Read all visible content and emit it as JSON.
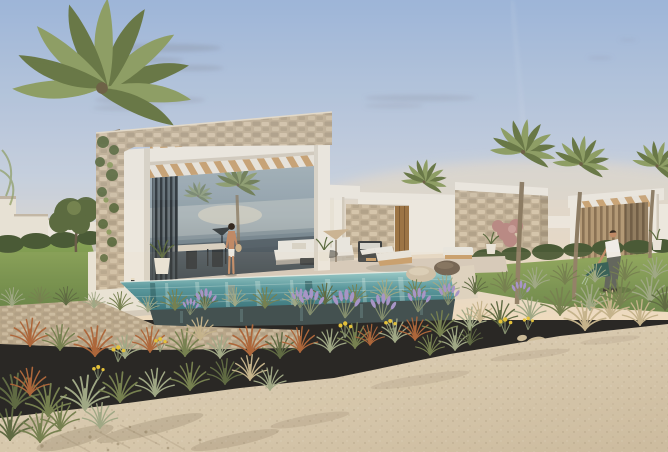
{
  "scene": {
    "type": "architectural-rendering",
    "description": "Architectural rendering of modern single-storey stone-and-white villas with wooden pergolas, an infinity-edge swimming pool, palm trees, ornamental grasses, lavender and a sandy path in the foreground at dusk",
    "time_of_day": "dusk",
    "weather": "clear with thin wispy clouds",
    "buildings": [
      {
        "name": "main-villa",
        "features": "stone parapet, white frame, timber pergola slats, vertical louvers, full-height glazing reflecting sea and palms"
      },
      {
        "name": "middle-villa-wing",
        "features": "white parapet, stone panel, timber door"
      },
      {
        "name": "stone-block-villa",
        "features": "stone clad walls with white parapet"
      },
      {
        "name": "pergola-villa",
        "features": "white pergola frame with tan louvered wall"
      }
    ],
    "people": [
      {
        "name": "woman-by-pool",
        "description": "woman in white shorts standing at the pool terrace edge with a straw bag"
      },
      {
        "name": "man-gardening",
        "description": "man in a white t-shirt watering plants on the lawn with a teal watering can"
      }
    ],
    "palm_tree_count": 5,
    "water_feature": "infinity edge swimming pool over a dry-stacked stone retaining wall",
    "vegetation": "ornamental grasses (olive, sage, rust, straw), lavender clumps, yellow wildflowers, trimmed hedges, lawn, pink flowering shrub",
    "foreground": "light sandy path with scattered pebbles, rocks and plant shadows",
    "furniture": "outdoor dining set, white lounge sofas, timber sun loungers, pebble-shaped poufs, planted pots, parasols"
  },
  "palette": {
    "skyTop": "#9db5d7",
    "skyMid": "#c7d0dd",
    "horizonGlow": "#efdcc0",
    "cloud": "#7e828d",
    "white": "#ece7dd",
    "whiteShade": "#d3cbbc",
    "stoneBase": "#c2b197",
    "stoneDark": "#a6957d",
    "stoneLight": "#d9cab0",
    "wallStone": "#b5a488",
    "wood": "#c79e6b",
    "woodDark": "#a07747",
    "slatBright": "#e9e4da",
    "louverDark": "#272d31",
    "louverTanBase": "#b49a76",
    "louverTanDark": "#8a7254",
    "glassTop": "#a8b4ba",
    "glassMid": "#90a0a8",
    "glassDark": "#49545b",
    "seaRef": "#7b8a92",
    "trunk": "#8d7c63",
    "trunkLight": "#a5947a",
    "palmDark": "#66743f",
    "palmLight": "#8d9c5e",
    "treeGreen": "#5c6b40",
    "hedge": "#4a5a36",
    "lawnLight": "#8aa557",
    "lawnDark": "#617f41",
    "pathGrey": "#c9c4b8",
    "terrace": "#d6cabb",
    "coping": "#ddd2c0",
    "ledgeWhite": "#e9e3d7",
    "poolLight": "#9ccfce",
    "poolMid": "#4f939b",
    "poolDeep": "#2e6d77",
    "poolEdgeDark": "#37474a",
    "sandLight": "#e1d5bd",
    "sandDark": "#cbbb9f",
    "speck": "#8a7a5e",
    "shadowSand": "#6b5a40",
    "tuftOlive": "#6e7b4a",
    "tuftSage": "#9aa583",
    "tuftDark": "#55633c",
    "rust": "#a85f33",
    "straw": "#c2b189",
    "lavenderC": "#a291c9",
    "stemGreen": "#7d8a6a",
    "flowerYellow": "#e2c033",
    "skin": "#c08a66",
    "hair": "#35291f",
    "shirtWhite": "#efece6",
    "shortsWhite": "#eceae2",
    "pants": "#5a5f58",
    "canTeal": "#2e5a52",
    "bagStraw": "#cbb089",
    "pebbleLight": "#cdbfa7",
    "pebbleDark": "#6e5f4f",
    "rockBeige": "#c9b896",
    "doorWood": "#9c7444",
    "pinkShrub": "#b98a84",
    "parasolTan": "#cbb493",
    "furnDark": "#33373a",
    "sofaWhite": "#e8e5dd",
    "distantWall": "#e7e1d4"
  }
}
